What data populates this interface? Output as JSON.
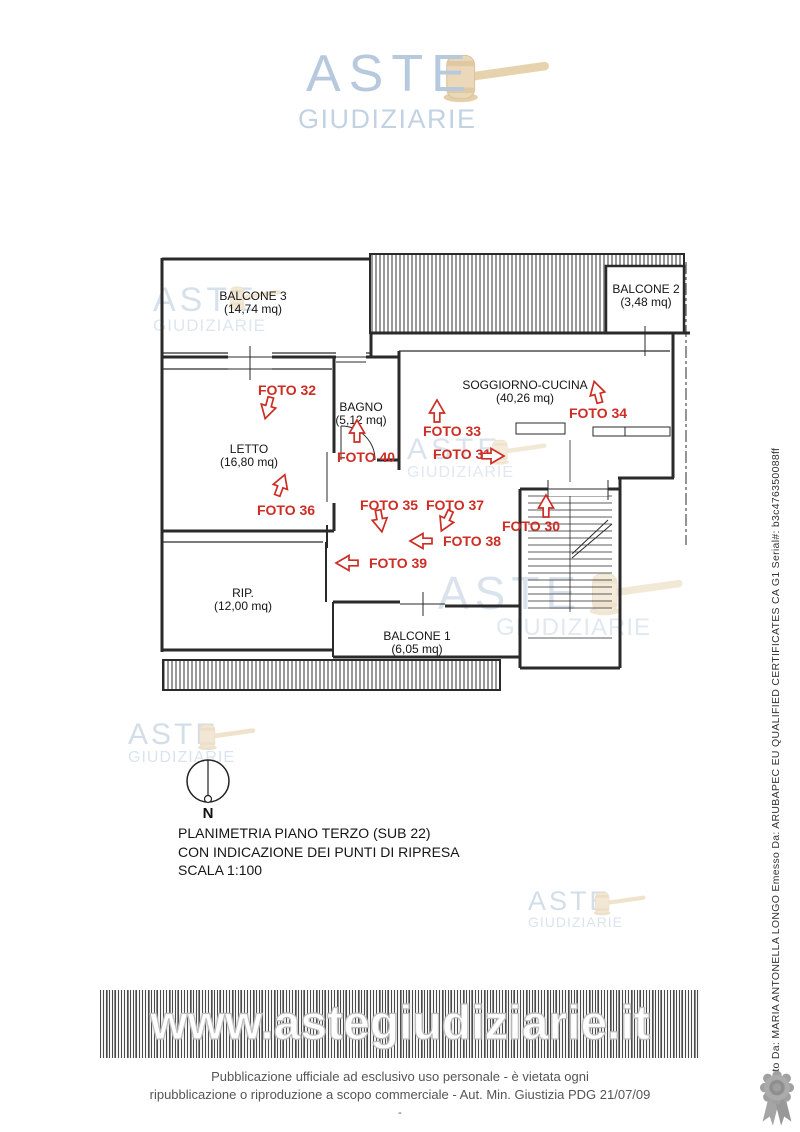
{
  "brand": {
    "line1": "ASTE",
    "line2": "GIUDIZIARIE"
  },
  "colors": {
    "accent_red": "#cc2d24",
    "brand_blue": "#b7c9dc",
    "gavel_beige": "#ead8b8"
  },
  "plan": {
    "rooms": [
      {
        "name": "BALCONE 3",
        "area": "(14,74 mq)"
      },
      {
        "name": "BALCONE 2",
        "area": "(3,48 mq)"
      },
      {
        "name": "SOGGIORNO-CUCINA",
        "area": "(40,26 mq)"
      },
      {
        "name": "BAGNO",
        "area": "(5,12 mq)"
      },
      {
        "name": "LETTO",
        "area": "(16,80 mq)"
      },
      {
        "name": "RIP.",
        "area": "(12,00 mq)"
      },
      {
        "name": "BALCONE 1",
        "area": "(6,05 mq)"
      }
    ],
    "fotos": [
      "FOTO 30",
      "FOTO 31",
      "FOTO 32",
      "FOTO 33",
      "FOTO 34",
      "FOTO 35",
      "FOTO 36",
      "FOTO 37",
      "FOTO 38",
      "FOTO 39",
      "FOTO 40"
    ]
  },
  "compass": {
    "north_label": "N"
  },
  "caption": {
    "line1": "PLANIMETRIA  PIANO TERZO (SUB 22)",
    "line2": "CON INDICAZIONE DEI PUNTI DI RIPRESA",
    "line3": "SCALA 1:100"
  },
  "footer": {
    "url": "www.astegiudiziarie.it",
    "line1": "Pubblicazione ufficiale ad esclusivo uso personale - è vietata ogni",
    "line2": "ripubblicazione o riproduzione a scopo commerciale - Aut. Min. Giustizia PDG 21/07/09",
    "dash": "-"
  },
  "signature": {
    "text": "Firmato Da: MARIA ANTONELLA LONGO Emesso Da: ARUBAPEC EU QUALIFIED CERTIFICATES CA G1 Serial#: b3c476350088ff"
  }
}
